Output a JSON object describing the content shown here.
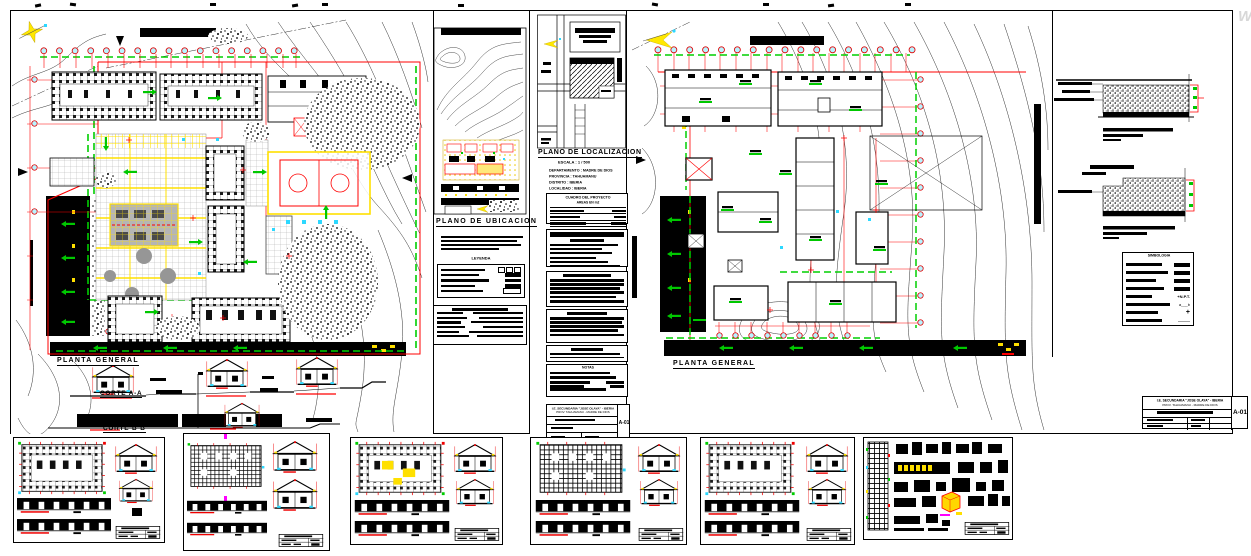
{
  "plans": {
    "left_title": "PLANTA GENERAL",
    "right_title": "PLANTA GENERAL"
  },
  "sections": {
    "corte_a": "CORTE A-A",
    "corte_b": "CORTE B-B"
  },
  "location": {
    "ubicacion_title": "PLANO DE UBICACION",
    "localizacion_title": "PLANO DE LOCALIZACION",
    "escala": "ESCALA : 1 / 500",
    "fields": [
      "DEPARTAMENTO : MADRE DE DIOS",
      "PROVINCIA : TAHUAMANU",
      "DISTRITO : IBERIA",
      "LOCALIDAD : IBERIA"
    ]
  },
  "tables": {
    "cuadro_title": "CUADRO DEL PROYECTO",
    "cuadro_subtitle": "AREAS EN m2",
    "leyenda_title": "LEYENDA",
    "simbologia_title": "SIMBOLOGIA",
    "notas_title": "NOTAS"
  },
  "legend": {
    "npt": "+N.P.T.",
    "ab": "a___b",
    "plus": "+",
    "dash": "———"
  },
  "titleblock": {
    "line1": "I.E. SECUNDARIA \"JOSE OLAYA\" - IBERIA",
    "line2": "PROV. TAHUAMANU - MADRE DE DIOS",
    "code": "A-01"
  },
  "watermark": "W",
  "colors": {
    "grid_red": "#ff0000",
    "arrow_green": "#00c800",
    "court_yellow": "#ffe000",
    "bubble_cyan": "#b8f3ff"
  }
}
